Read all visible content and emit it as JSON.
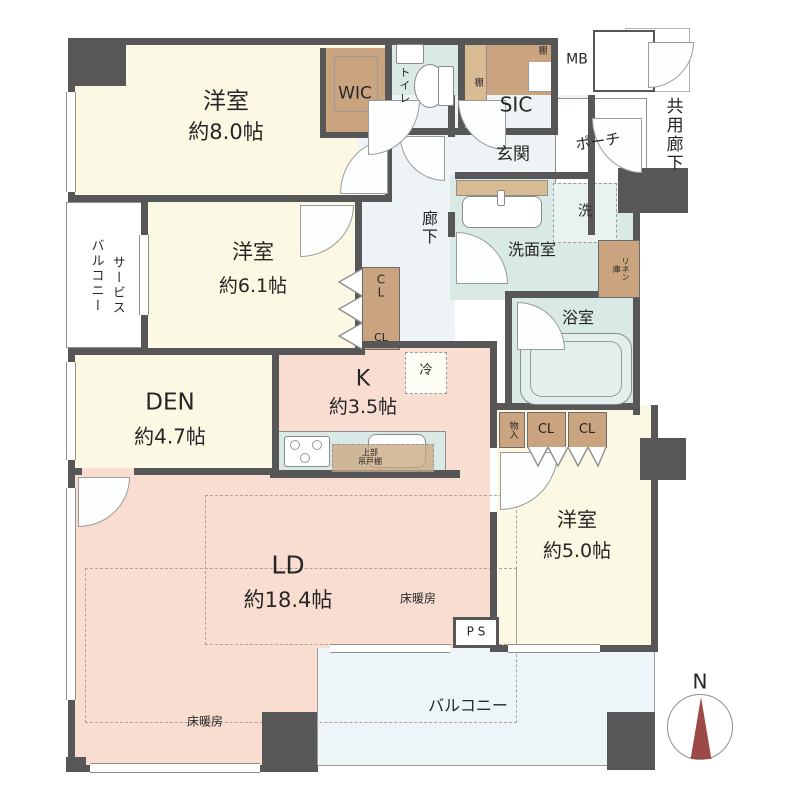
{
  "rooms": {
    "bedroom8": {
      "label": "洋室",
      "area": "約8.0帖"
    },
    "bedroom61": {
      "label": "洋室",
      "area": "約6.1帖"
    },
    "bedroom50": {
      "label": "洋室",
      "area": "約5.0帖"
    },
    "den": {
      "label": "DEN",
      "area": "約4.7帖"
    },
    "kitchen": {
      "label": "K",
      "area": "約3.5帖"
    },
    "living_dining": {
      "label": "LD",
      "area": "約18.4帖"
    },
    "entrance": "玄関",
    "hallway": "廊下",
    "toilet": "トイレ",
    "washroom": "洗面室",
    "washer": "洗",
    "bathroom": "浴室",
    "service_balcony_l1": "サービス",
    "service_balcony_l2": "バルコニー",
    "balcony": "バルコニー",
    "porch": "ポーチ",
    "common_corridor": "共用廊下"
  },
  "storage": {
    "wic": "WIC",
    "sic": "SIC",
    "shelf_side": "棚",
    "shelf_corner": "棚",
    "cl_mid_c": "C",
    "cl_mid_l": "L",
    "cl_mid_cl": "CL",
    "closet_left": "CL",
    "closet_right": "CL",
    "storage_small": "物入",
    "linen": "リネン庫",
    "fridge": "冷",
    "hanging_l1": "上部",
    "hanging_l2": "吊戸棚",
    "meter_box": "MB",
    "pipe_space": "P S"
  },
  "annotations": {
    "floor_heating": "床暖房",
    "compass_north": "N"
  },
  "colors": {
    "wall": "#575757",
    "western_room": "#fbf8e3",
    "closet": "#c9a47e",
    "wet_area": "#d9eae6",
    "ldk": "#f9ddd1",
    "hall": "#eef4f6",
    "balcony": "#eef5f8",
    "compass_needle": "#9c4a48"
  }
}
